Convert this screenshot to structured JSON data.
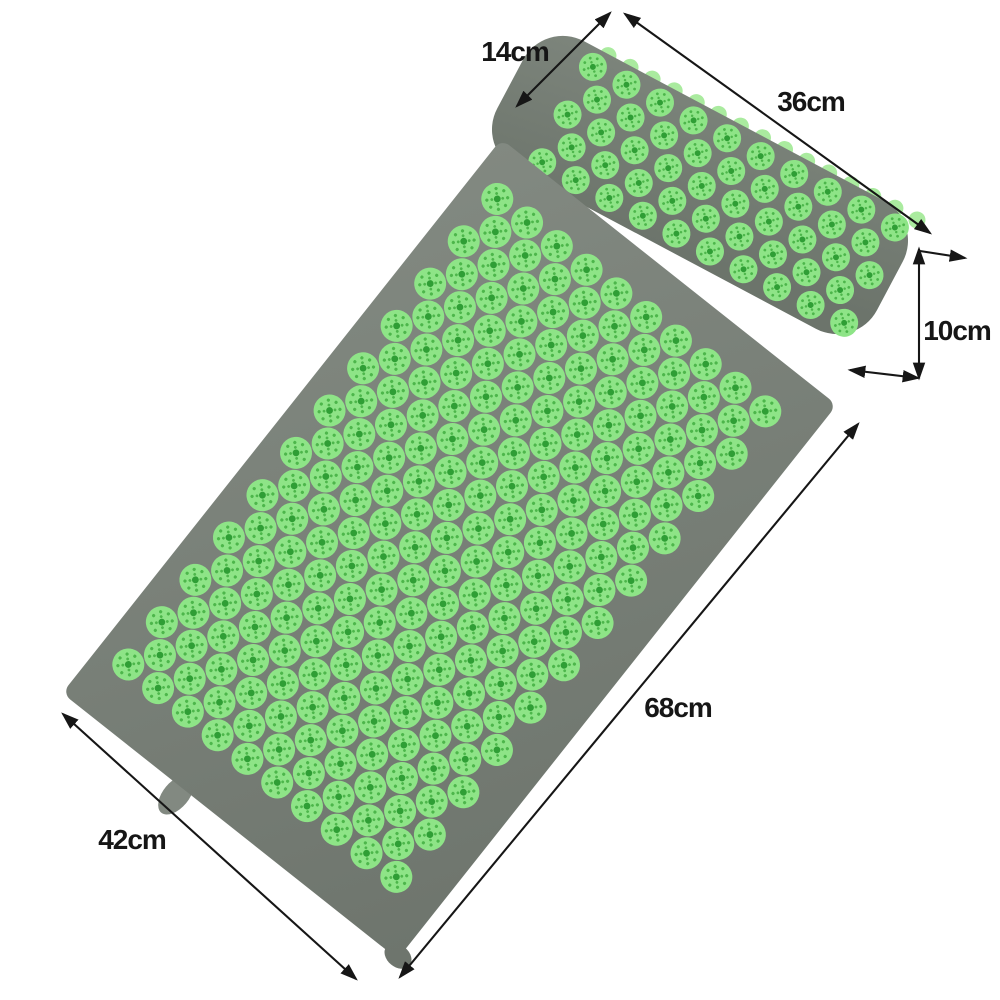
{
  "image": {
    "background": "#ffffff"
  },
  "colors": {
    "background": "#ffffff",
    "ink": "#161616",
    "mat_fabric": "#828981",
    "mat_fabric_dark": "#6e756d",
    "pillow_fabric": "#7d857c",
    "pillow_fabric_dark": "#6c746b",
    "spike": "#8ee487",
    "spike_center": "#2f9e35",
    "spike_speckle": "#4db64b",
    "fringe": "#aaeb9f"
  },
  "dimensions": {
    "pillow_depth": {
      "label": "14cm"
    },
    "pillow_length": {
      "label": "36cm"
    },
    "pillow_height": {
      "label": "10cm"
    },
    "mat_length": {
      "label": "68cm"
    },
    "mat_width": {
      "label": "42cm"
    }
  },
  "mat": {
    "spike_grid": {
      "orientation": "rows-along-y",
      "rows": 23,
      "row_start": -290,
      "row_pitch": 27,
      "col_start": -180,
      "col_pitch": 38,
      "cols_even": 10,
      "cols_odd": 9,
      "odd_offset": 19,
      "spike_scale": 1
    }
  },
  "pillow": {
    "spike_grid": {
      "orientation": "rows-along-x",
      "rows": 5,
      "row_start": -54,
      "row_pitch": 27,
      "col_start": -150,
      "col_pitch": 38,
      "cols_even": 10,
      "cols_odd": 9,
      "odd_offset": 19,
      "spike_scale": 0.875
    },
    "fringe": {
      "count": 15,
      "x_start": -142,
      "pitch": 25,
      "y": -71,
      "radius": 8.5
    }
  }
}
